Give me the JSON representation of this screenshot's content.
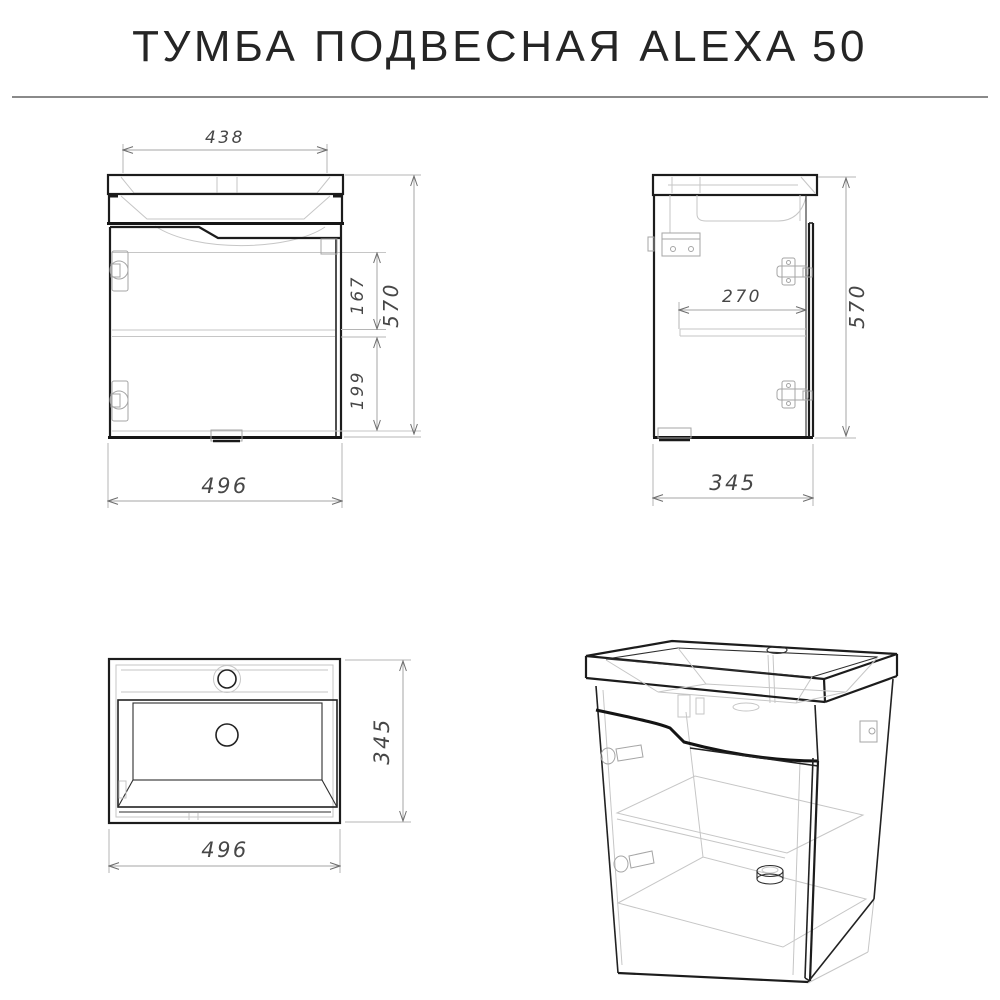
{
  "title": "ТУМБА ПОДВЕСНАЯ ALEXA 50",
  "colors": {
    "main_line": "#1c1c1c",
    "hidden_line": "#c6c6c6",
    "dimension_line": "#a6a6a6",
    "dimension_text": "#474747",
    "background": "#ffffff"
  },
  "views": {
    "front": {
      "dims": {
        "width_top": "438",
        "height": "570",
        "inner_upper": "167",
        "inner_lower": "199",
        "width_bottom": "496"
      }
    },
    "side": {
      "dims": {
        "shelf_depth": "270",
        "height": "570",
        "depth": "345"
      }
    },
    "top": {
      "dims": {
        "depth": "345",
        "width": "496"
      }
    }
  }
}
